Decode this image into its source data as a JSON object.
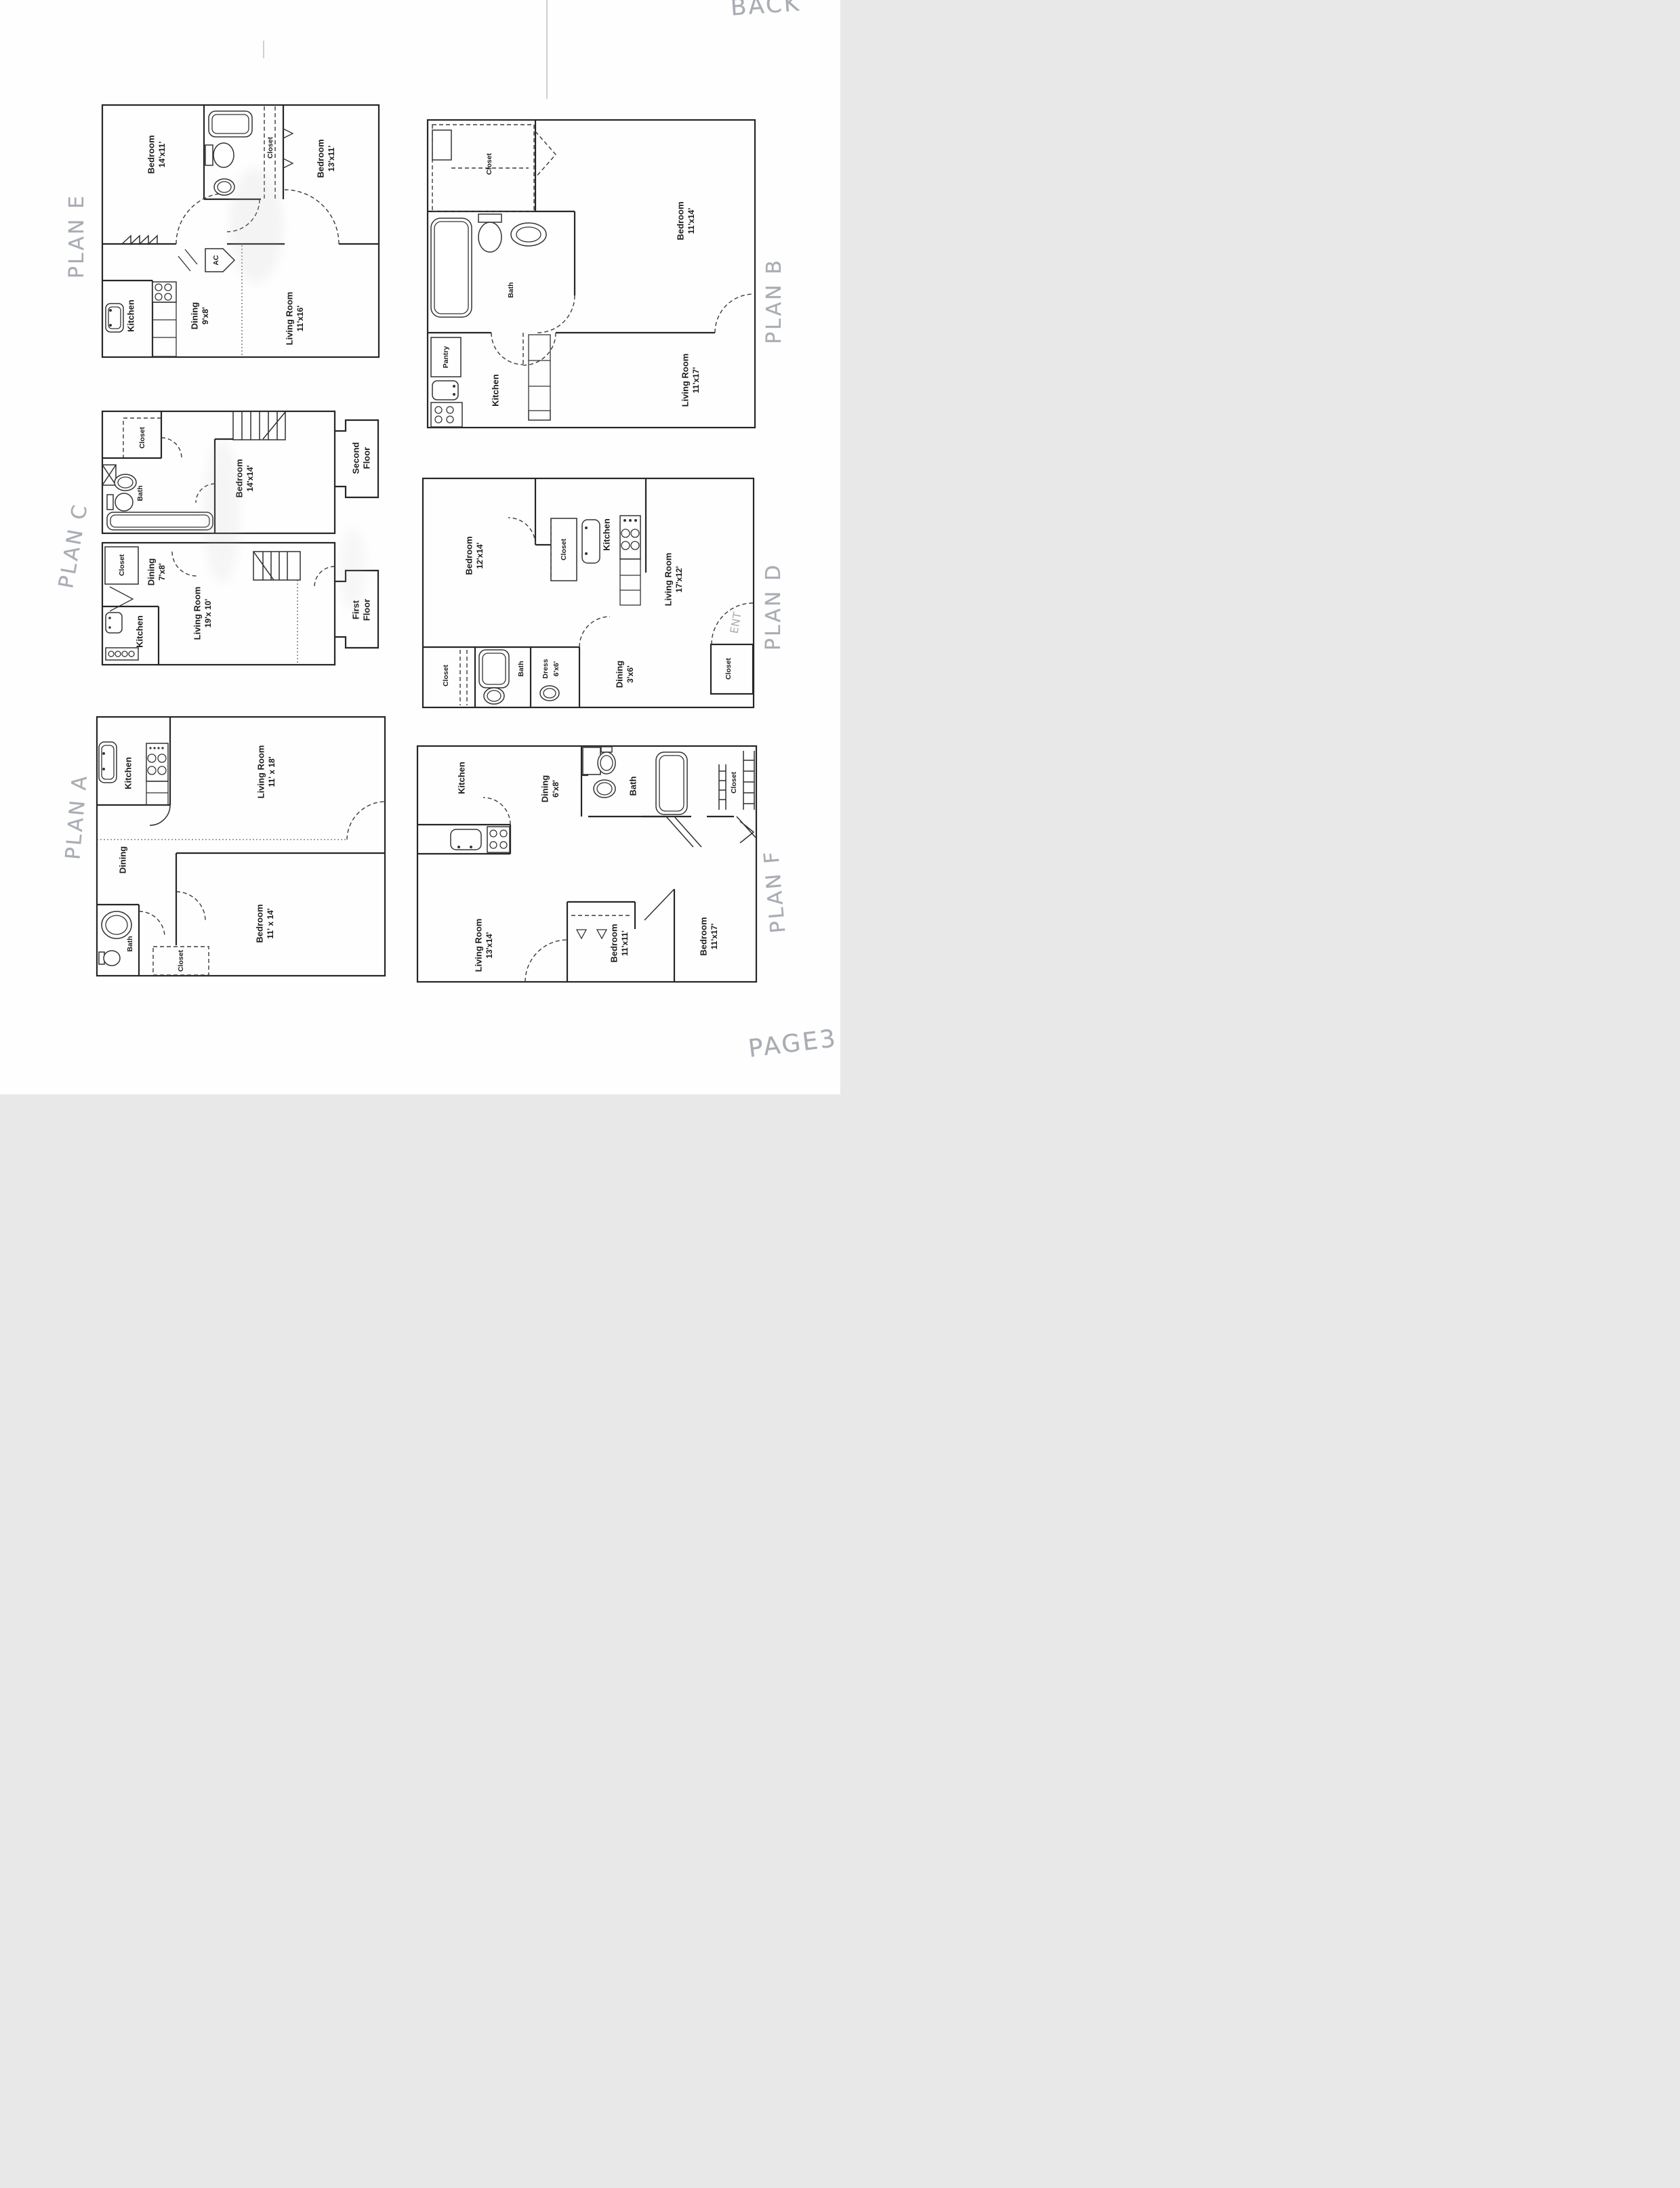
{
  "plans": {
    "e": {
      "label": "PLAN E",
      "bedroom1": "Bedroom",
      "bedroom1_dim": "14'x11'",
      "closet": "Closet",
      "bedroom2": "Bedroom",
      "bedroom2_dim": "13'x11'",
      "kitchen": "Kitchen",
      "dining": "Dining",
      "dining_dim": "9'x8'",
      "ac": "AC",
      "living": "Living Room",
      "living_dim": "11'x16'"
    },
    "b": {
      "label": "PLAN B",
      "closet": "Closet",
      "bath": "Bath",
      "bedroom": "Bedroom",
      "bedroom_dim": "11'x14'",
      "pantry": "Pantry",
      "kitchen": "Kitchen",
      "living": "Living Room",
      "living_dim": "11'x17'"
    },
    "c": {
      "label": "PLAN C",
      "closet_upper": "Closet",
      "bath": "Bath",
      "bedroom": "Bedroom",
      "bedroom_dim": "14'x14'",
      "second_floor_line1": "Second",
      "second_floor_line2": "Floor",
      "closet_lower": "Closet",
      "dining": "Dining",
      "dining_dim": "7'x8'",
      "kitchen": "Kitchen",
      "living": "Living Room",
      "living_dim": "19'x 10'",
      "first_floor_line1": "First",
      "first_floor_line2": "Floor"
    },
    "d": {
      "label": "PLAN D",
      "bedroom": "Bedroom",
      "bedroom_dim": "12'x14'",
      "closet_mid": "Closet",
      "kitchen": "Kitchen",
      "living": "Living Room",
      "living_dim": "17'x12'",
      "closet_left": "Closet",
      "bath": "Bath",
      "dress": "Dress",
      "dress_dim": "6'x6'",
      "dining": "Dining",
      "dining_dim": "3'x6'",
      "closet_br": "Closet",
      "ent": "ENT"
    },
    "a": {
      "label": "PLAN A",
      "kitchen": "Kitchen",
      "living": "Living Room",
      "living_dim": "11' x 18'",
      "dining": "Dining",
      "bath": "Bath",
      "closet": "Closet",
      "bedroom": "Bedroom",
      "bedroom_dim": "11' x 14'"
    },
    "f": {
      "label": "PLAN F",
      "kitchen": "Kitchen",
      "dining": "Dining",
      "dining_dim": "6'x8'",
      "bath": "Bath",
      "closet": "Closet",
      "living": "Living Room",
      "living_dim": "13'x14'",
      "bedroom1": "Bedroom",
      "bedroom1_dim": "11'x11'",
      "bedroom2": "Bedroom",
      "bedroom2_dim": "11'x17'"
    }
  },
  "annotations": {
    "back": "BACK",
    "page_number": "PAGE3"
  }
}
